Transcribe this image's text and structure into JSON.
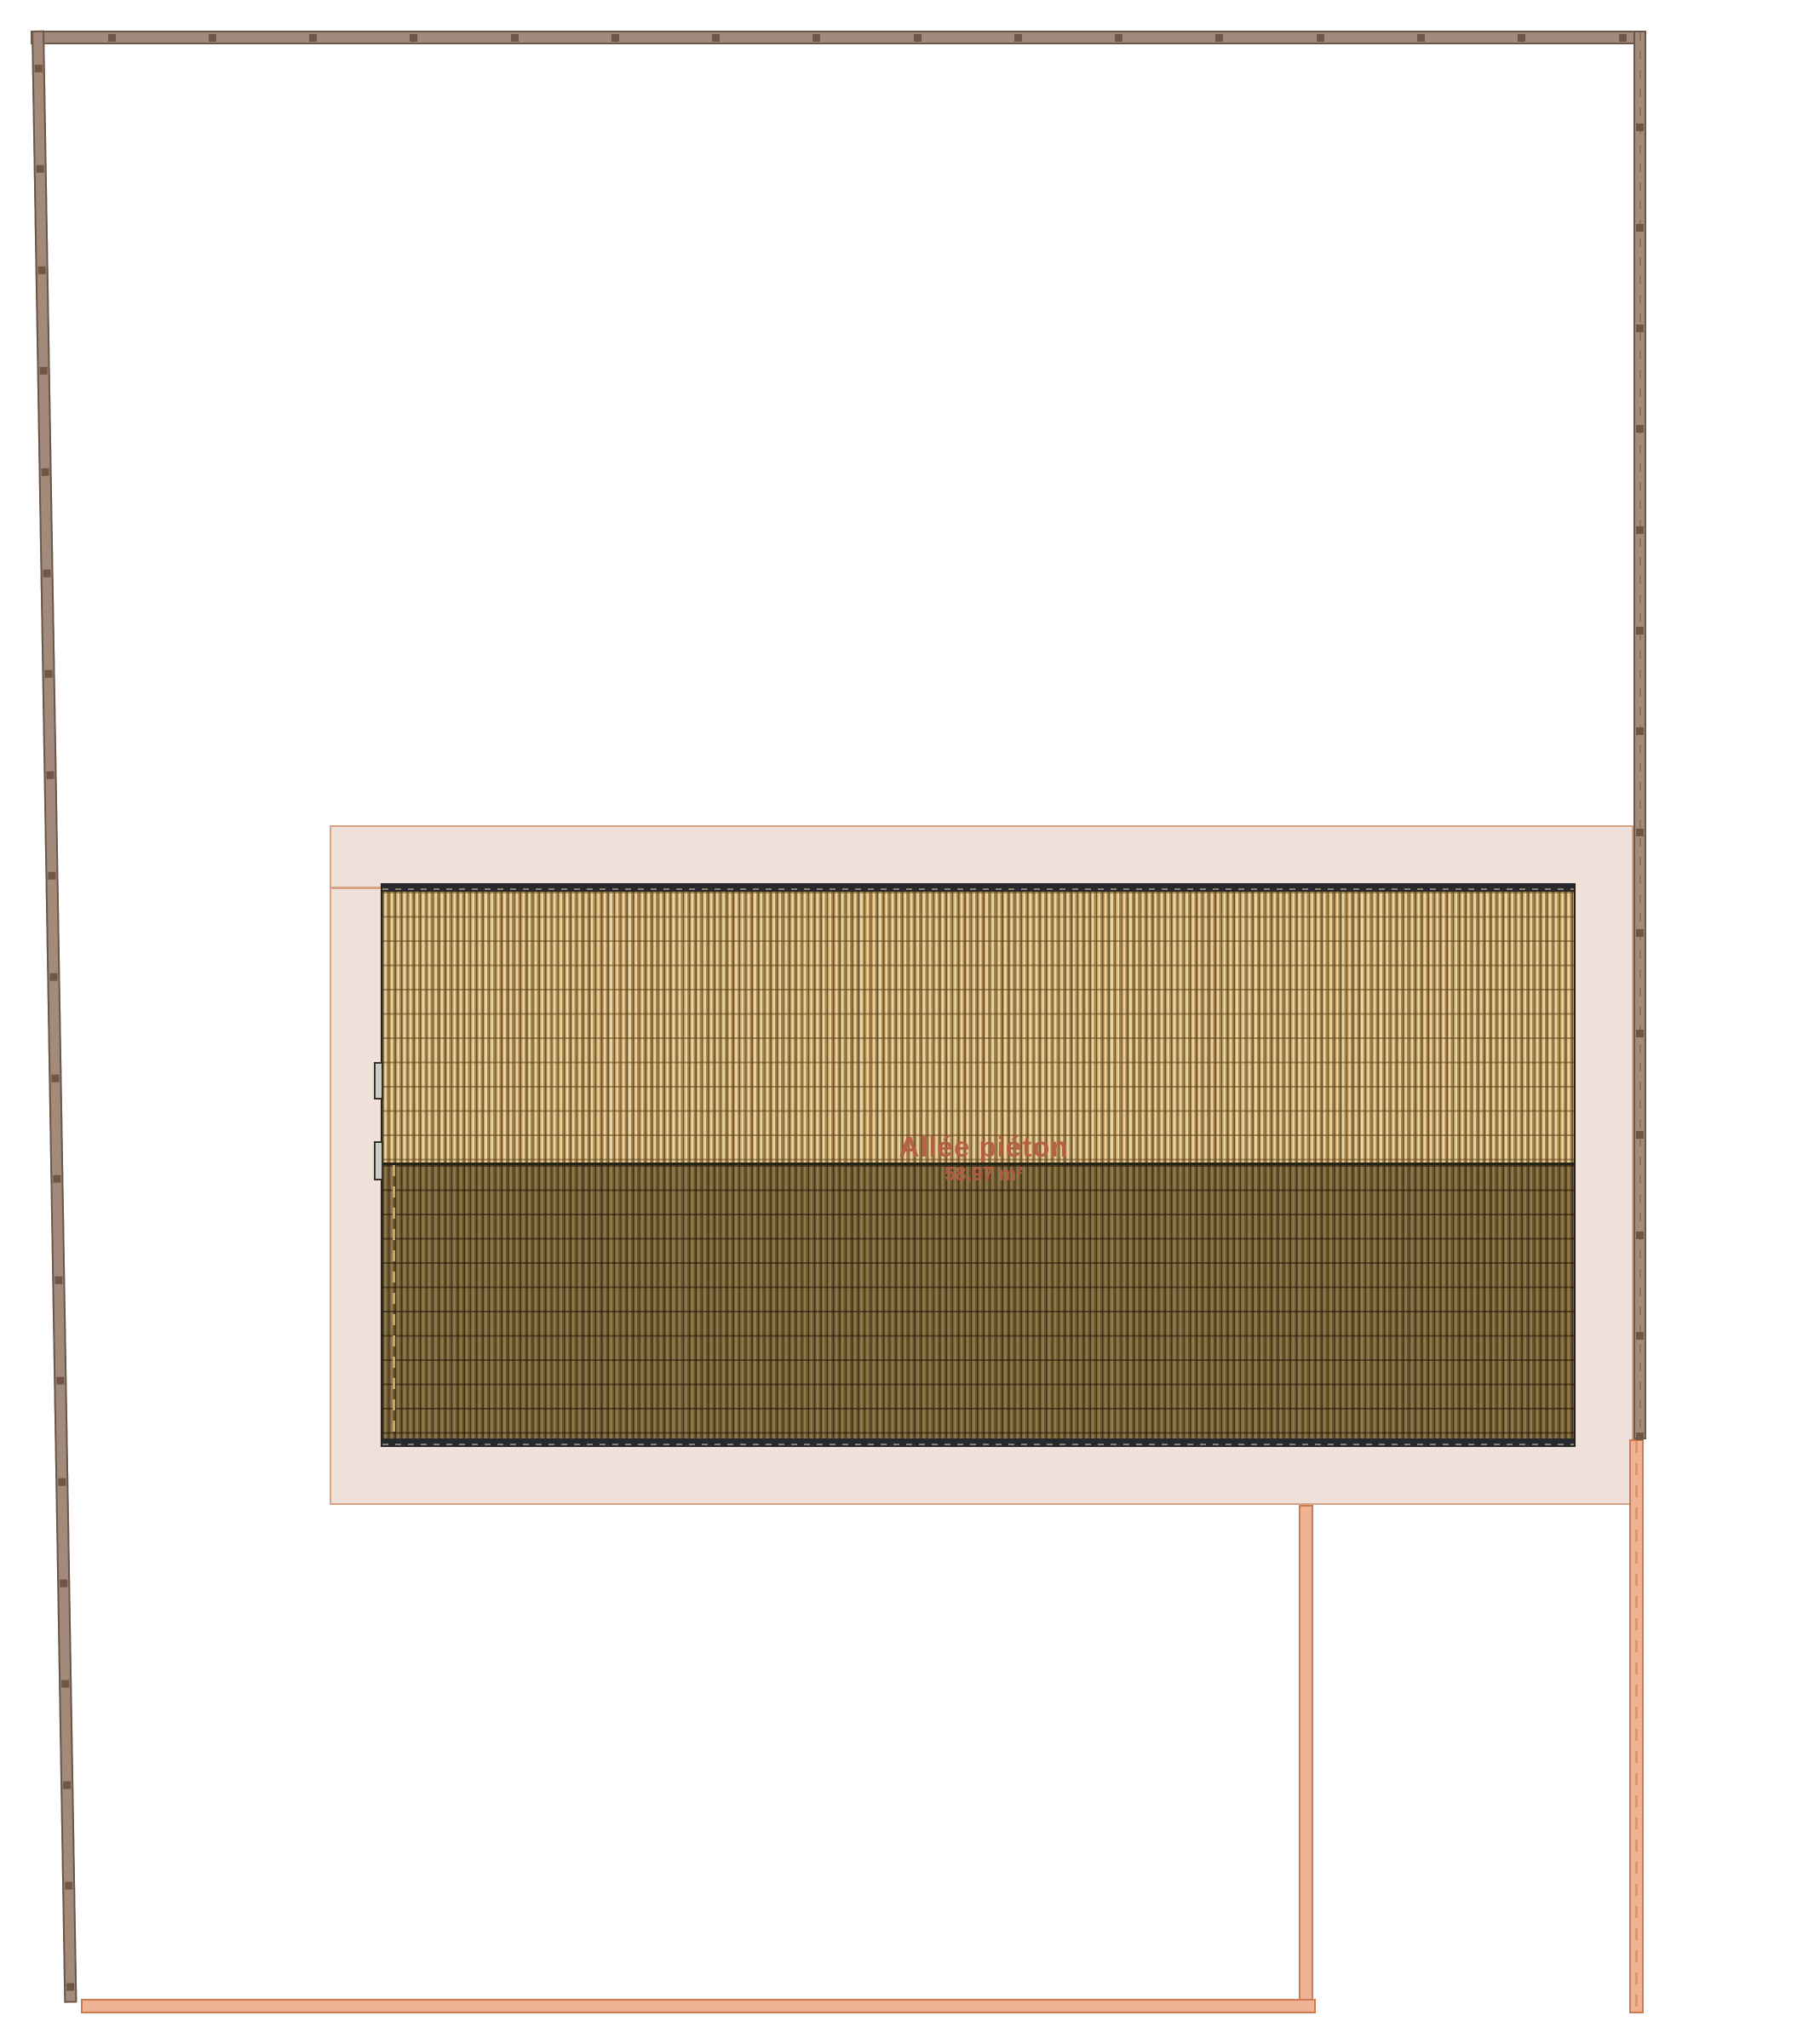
{
  "labels": {
    "walkway_title": "Allée piéton",
    "walkway_area": "58.97 m²"
  },
  "colors": {
    "fence_fill": "#a28b7d",
    "fence_border": "#6b5749",
    "fence_post": "#6f5646",
    "walkway_fill": "#efe1da",
    "walkway_border": "#d8a284",
    "boundary_fill": "#eeb294",
    "boundary_border": "#cf7b52",
    "roof_eave": "#26292d",
    "roof_eave_dash": "#8d7f6d",
    "roof_light_base": "#e6d4a2",
    "roof_light_stripe": "#6d5129",
    "roof_dark_base": "#8f7a47",
    "roof_dark_stripe": "#433217",
    "label_text": "#b65c44"
  },
  "fences": {
    "top": {
      "posts": 16
    },
    "right": {
      "posts": 14
    },
    "left": {
      "posts": 20
    }
  }
}
